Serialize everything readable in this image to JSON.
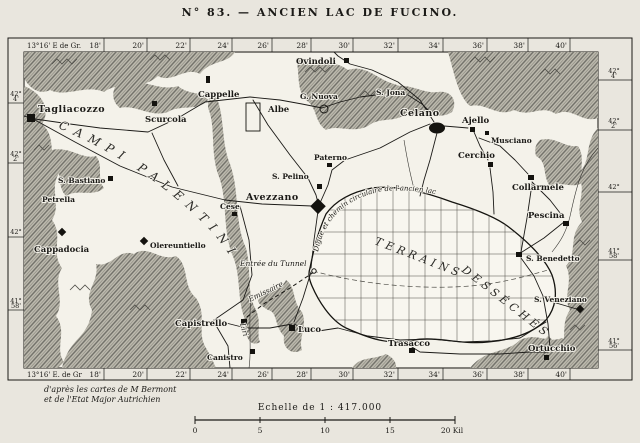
{
  "title": "N° 83. — ANCIEN LAC DE FUCINO.",
  "colors": {
    "paper": "#e9e6de",
    "map_bg": "#f4f2ea",
    "ink": "#1b1a17",
    "terrain": "#b7b4a9"
  },
  "border": {
    "origin_top": "13°16' E de Gr.",
    "origin_bottom": "13°16' E. de Gr",
    "top_ticks": [
      "18'",
      "20'",
      "22'",
      "24'",
      "26'",
      "28'",
      "30'",
      "32'",
      "34'",
      "36'",
      "38'",
      "40'"
    ],
    "bottom_ticks": [
      "18'",
      "20'",
      "22'",
      "24'",
      "26'",
      "28'",
      "30'",
      "32'",
      "34'",
      "36'",
      "38'",
      "40'"
    ],
    "left_lats": [
      {
        "deg": "42°",
        "min": "4'"
      },
      {
        "deg": "42°",
        "min": "2'"
      },
      {
        "deg": "42°",
        "min": ""
      },
      {
        "deg": "41°",
        "min": "58'"
      }
    ],
    "right_lats": [
      {
        "deg": "42°",
        "min": "4'"
      },
      {
        "deg": "42°",
        "min": "2'"
      },
      {
        "deg": "42°",
        "min": ""
      },
      {
        "deg": "41°",
        "min": "58'"
      },
      {
        "deg": "41°",
        "min": "56'"
      }
    ]
  },
  "labels": {
    "tagliacozzo": "Tagliacozzo",
    "scurcola": "Scurcola",
    "cappelle": "Cappelle",
    "albe": "Albe",
    "ovindoli": "Ovindoli",
    "g_nuova": "G. Nuova",
    "s_jona": "S. Jona",
    "celano": "Celano",
    "ajello": "Ajello",
    "musciano": "Musciano",
    "cerchio": "Cerchio",
    "collarmele": "Collarmele",
    "pescina": "Pescina",
    "paterno": "Paterno",
    "s_pelino": "S. Pelino",
    "avezzano": "Avezzano",
    "cese": "Cese",
    "s_bastiano": "S. Bastiano",
    "petrella": "Petrella",
    "cappadocia": "Cappadocia",
    "olereuntiello": "Olereuntiello",
    "capistrello": "Capistrello",
    "canistro": "Canistro",
    "luco": "Luco",
    "trasacco": "Trasacco",
    "s_benedetto": "S. Benedetto",
    "s_veneziano": "S. Veneziano",
    "ortucchio": "Ortucchio"
  },
  "regions": {
    "campi_palentini": "CAMPI PALENTINI",
    "terrains": "TERRAINS",
    "desseches": "DESSÉCHÉS"
  },
  "annotations": {
    "digue": "Digue et chemin circulaire de l'ancien lac",
    "entree_tunnel": "Entrée du Tunnel",
    "emissaire": "Emissaire",
    "liri": "Liri"
  },
  "credits": {
    "line1": "d'après les cartes de M Bermont",
    "line2": "et de l'Etat Major Autrichien"
  },
  "scalebar": {
    "caption": "Echelle de 1 : 417.000",
    "ticks": [
      "0",
      "5",
      "10",
      "15",
      "20 Kil"
    ]
  }
}
